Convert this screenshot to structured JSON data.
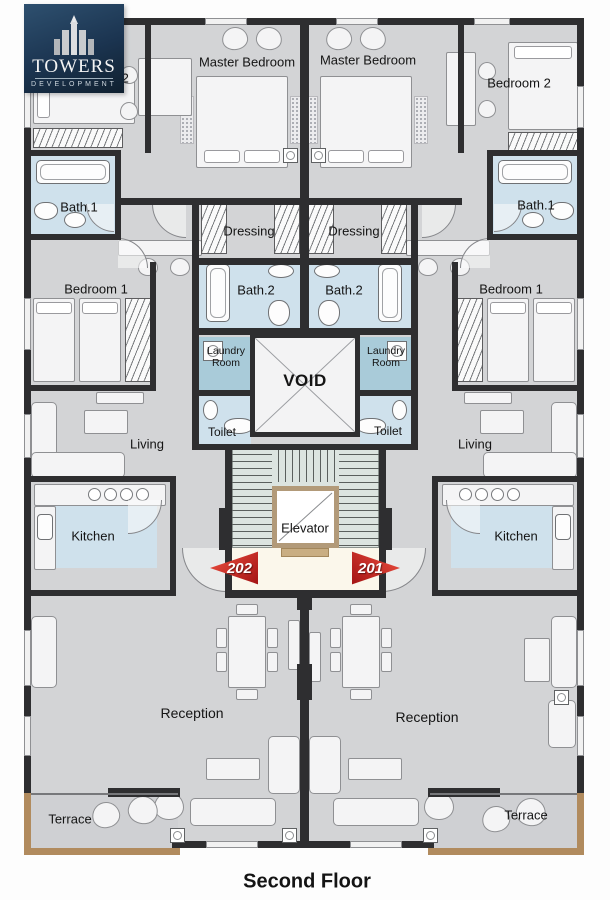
{
  "brand": {
    "title": "TOWERS",
    "subtitle": "DEVELOPMENT"
  },
  "plan": {
    "floor_label": "Second Floor",
    "core": {
      "void": "VOID",
      "elevator": "Elevator"
    },
    "units": {
      "left": "202",
      "right": "201"
    },
    "room_labels": {
      "master_bedroom": "Master Bedroom",
      "bedroom_2": "Bedroom 2",
      "bedroom_1": "Bedroom 1",
      "bath_1": "Bath.1",
      "bath_2": "Bath.2",
      "dressing": "Dressing",
      "laundry_room": "Laundry Room",
      "toilet": "Toilet",
      "living": "Living",
      "kitchen": "Kitchen",
      "reception": "Reception",
      "terrace": "Terrace"
    },
    "colors": {
      "wall": "#2e2e30",
      "floor": "#d3d4d6",
      "wet_room_blue": "#cfe1ec",
      "laundry_teal": "#a9cbd9",
      "stairs": "#dce4e0",
      "lobby_cream": "#fbf7eb",
      "elevator_frame": "#b29a79",
      "terrace_trim": "#b18b5e",
      "unit_arrow_red": "#c4161c",
      "logo_navy": "#1b3450"
    }
  }
}
